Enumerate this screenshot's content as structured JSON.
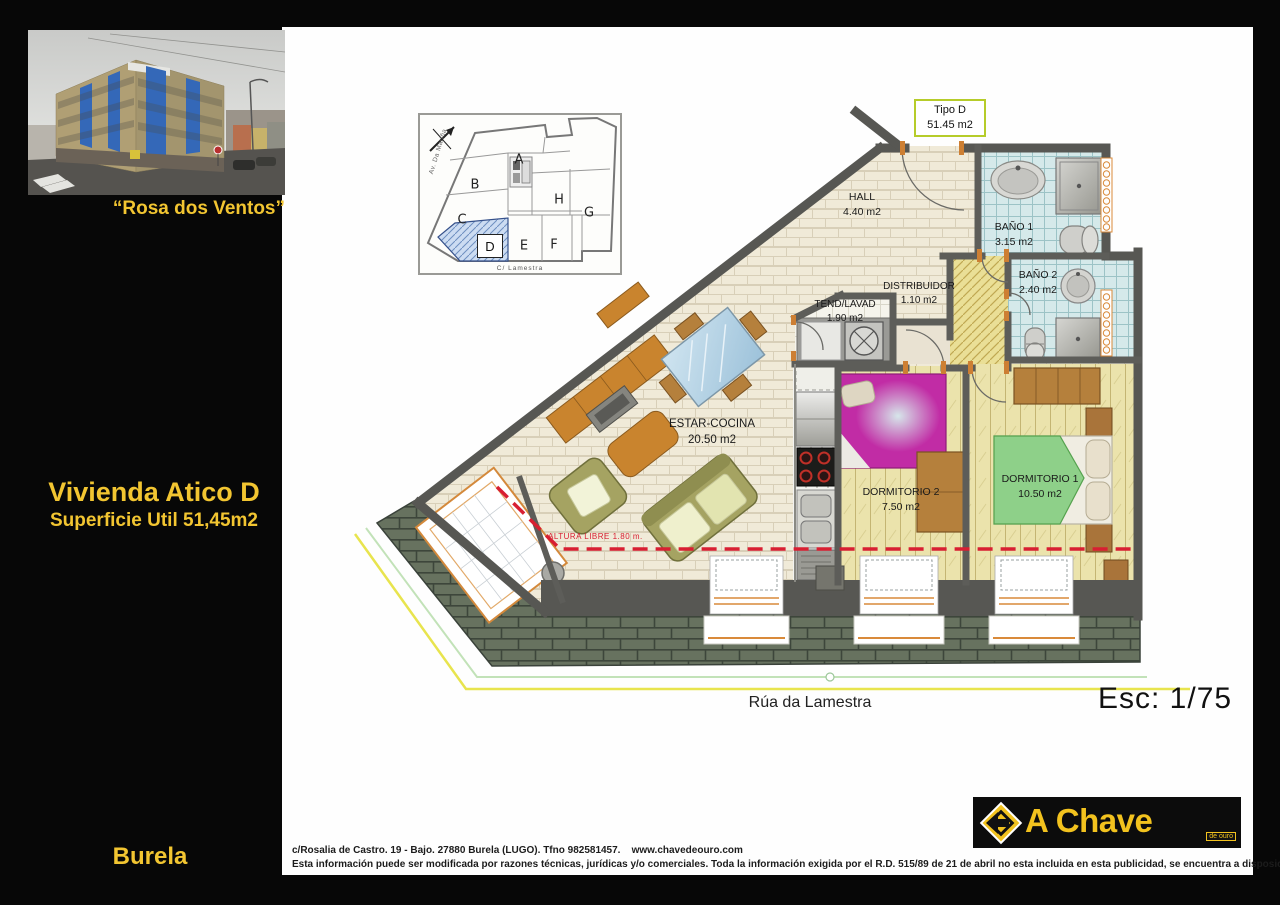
{
  "left_panel": {
    "photo_caption": "“Rosa dos Ventos”",
    "title": "Vivienda Atico D",
    "subtitle": "Superficie Util 51,45m2",
    "city": "Burela"
  },
  "plan": {
    "tipo_box": {
      "line1": "Tipo D",
      "line2": "51.45 m2"
    },
    "rooms": {
      "hall": {
        "name": "HALL",
        "area": "4.40 m2"
      },
      "bano1": {
        "name": "BAÑO 1",
        "area": "3.15 m2"
      },
      "bano2": {
        "name": "BAÑO 2",
        "area": "2.40 m2"
      },
      "distribuidor": {
        "name": "DISTRIBUIDOR",
        "area": "1.10 m2"
      },
      "tendedero": {
        "name": "TEND/LAVAD",
        "area": "1.90 m2"
      },
      "estar": {
        "name": "ESTAR-COCINA",
        "area": "20.50 m2"
      },
      "dormitorio2": {
        "name": "DORMITORIO 2",
        "area": "7.50 m2"
      },
      "dormitorio1": {
        "name": "DORMITORIO 1",
        "area": "10.50 m2"
      }
    },
    "altura_note": "ALTURA LIBRE 1.80 m.",
    "street_label": "Rúa da Lamestra",
    "scale_label": "Esc: 1/75"
  },
  "keyplan": {
    "units": [
      "A",
      "B",
      "C",
      "D",
      "E",
      "F",
      "G",
      "H"
    ],
    "highlight_unit": "D",
    "street_left": "Av. Da Mariña",
    "street_bottom": "C/ Lamestra"
  },
  "footer": {
    "address": "c/Rosalia de Castro. 19 - Bajo. 27880 Burela (LUGO). Tfno 982581457.    www.chavedeouro.com",
    "legal": "Esta información puede ser modificada por razones técnicas, jurídicas y/o comerciales. Toda la información exigida por el R.D. 515/89 de 21 de abril no esta incluida en esta publicidad, se encuentra a disposición de los interesados en nuestras oficinas .",
    "logo_main": "A Chave",
    "logo_sub": "de ouro"
  },
  "colors": {
    "accent_yellow": "#f2c531",
    "tipo_border": "#b6cc2a",
    "red_dash_line": "#d81f32",
    "bed2_magenta": "#c12ca5",
    "bed1_green": "#8ed089",
    "bath_tile": "#d5e9ea",
    "wood_floor": "#ebe3ac",
    "slate_roof": "#67725f",
    "wall_gray": "#575753"
  }
}
